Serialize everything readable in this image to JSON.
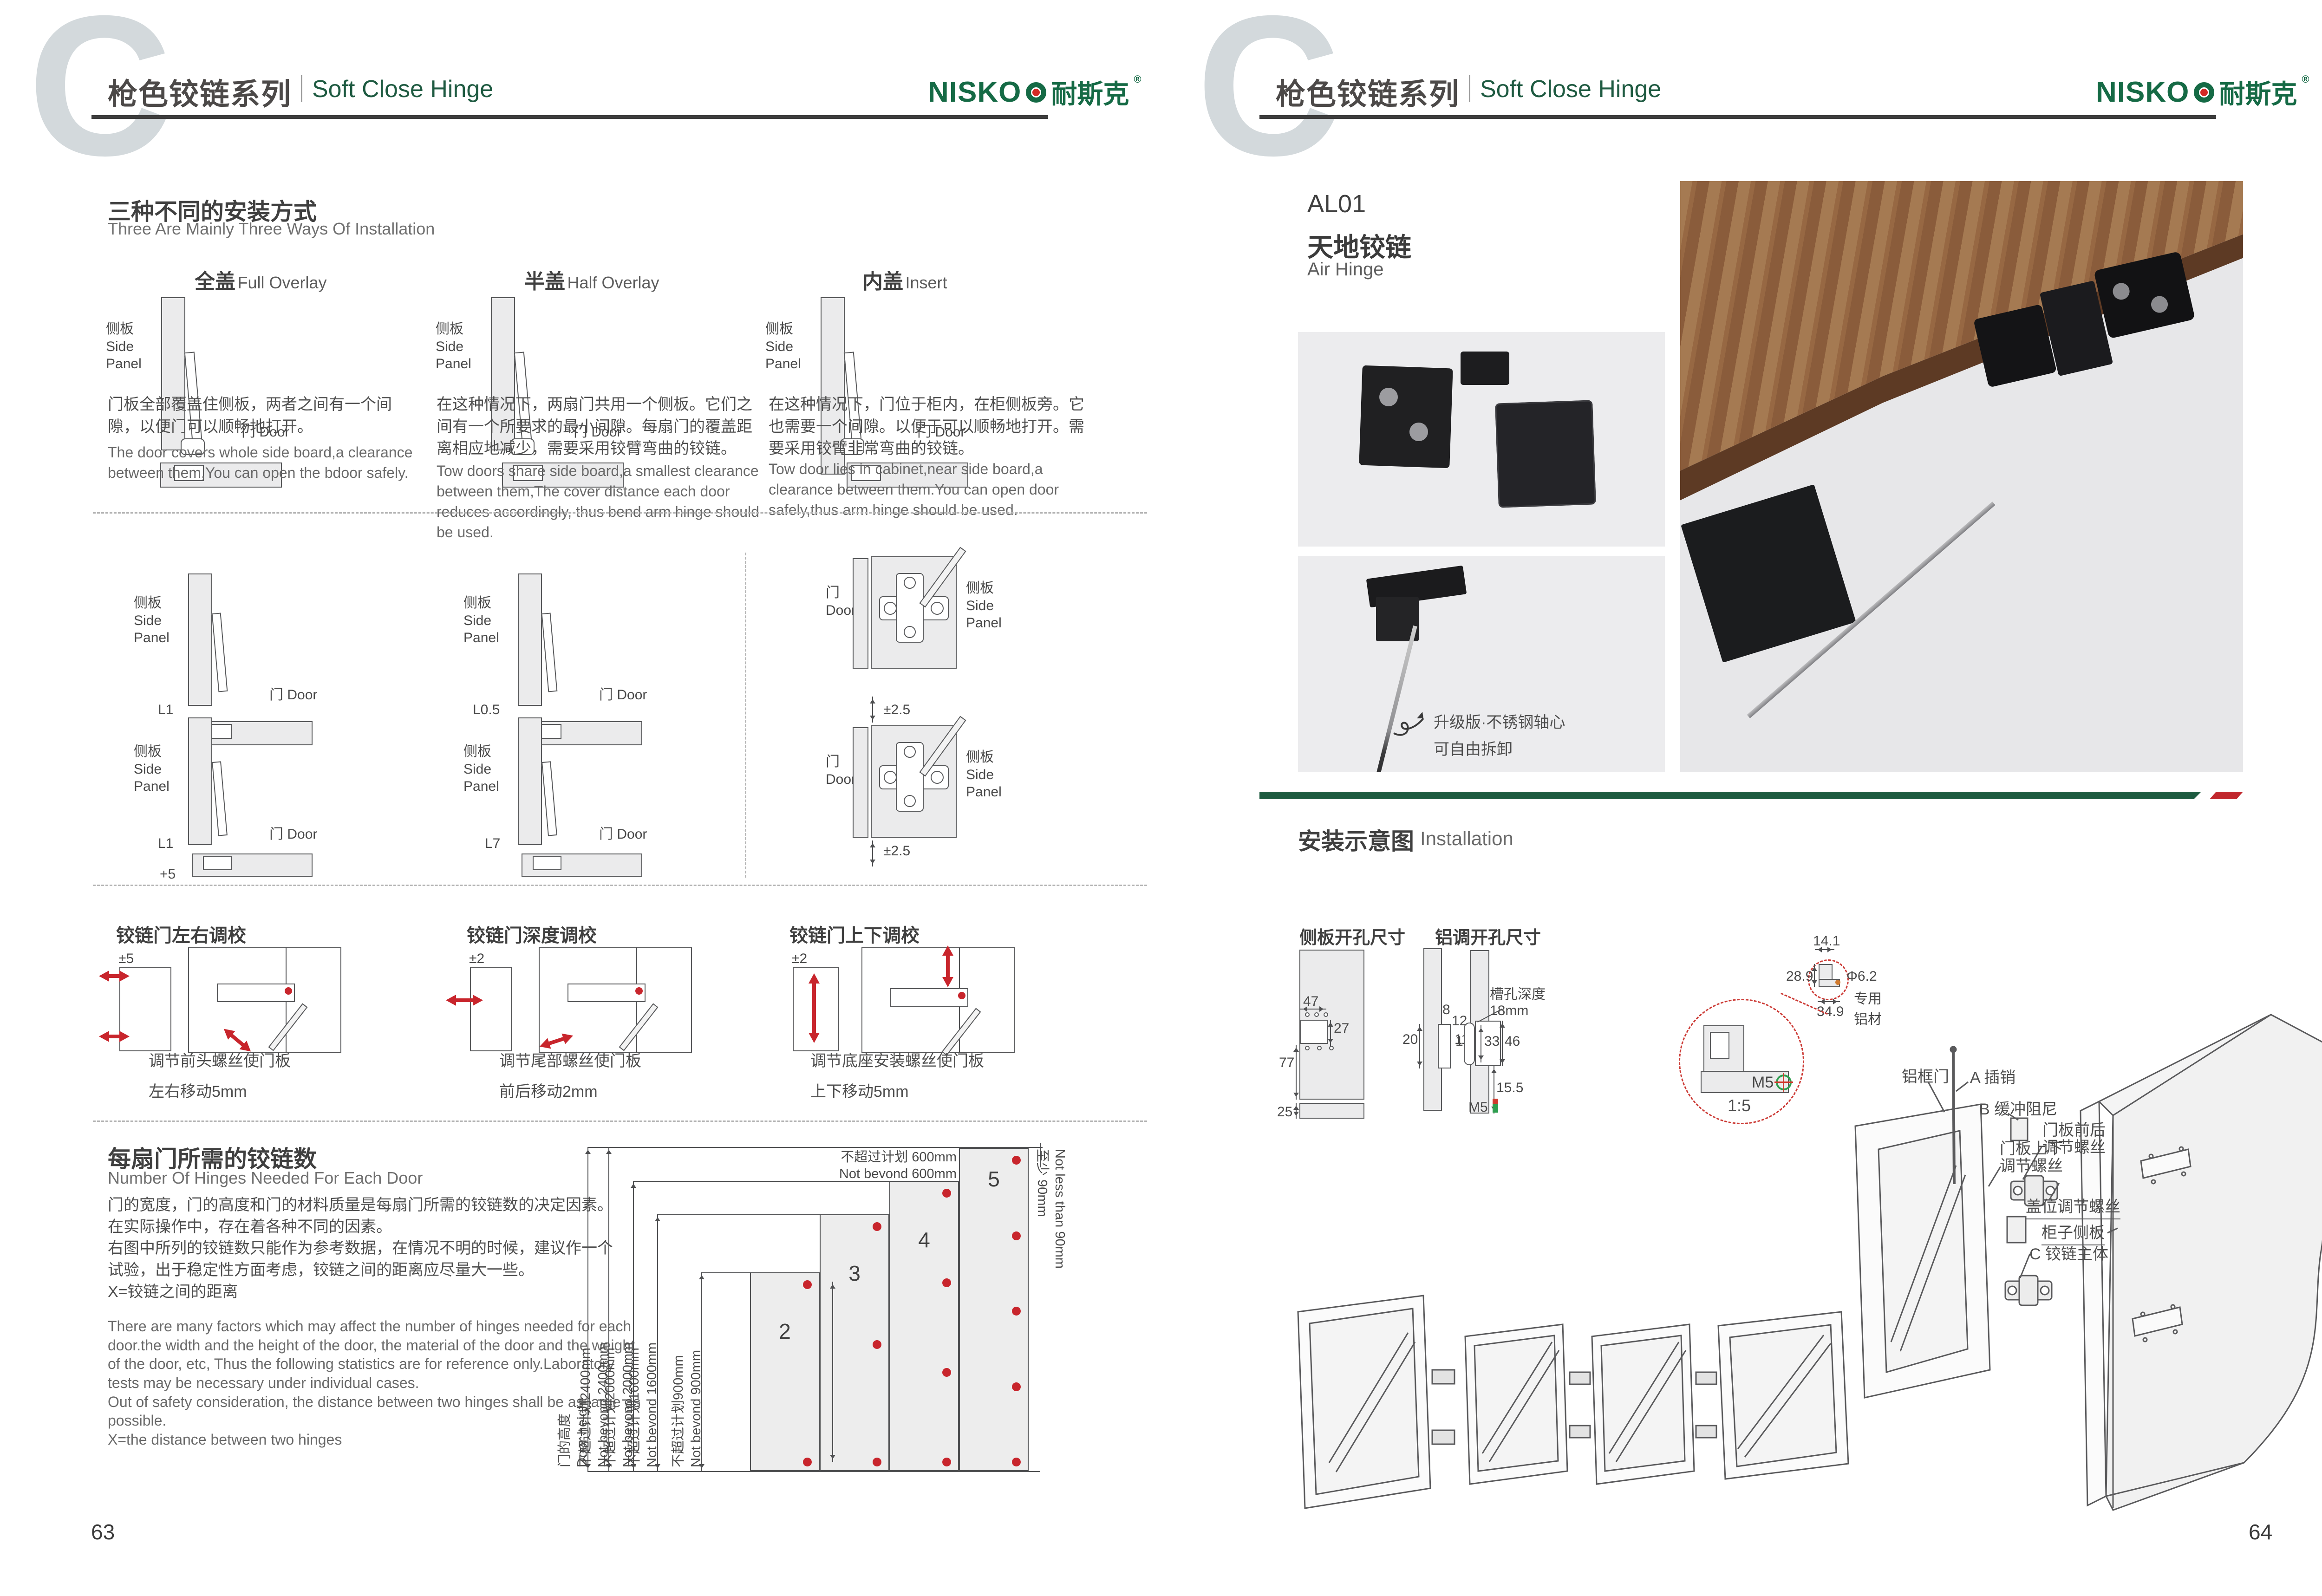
{
  "header": {
    "watermark": "C",
    "series_cn": "枪色铰链系列",
    "series_en": "Soft Close Hinge",
    "brand_latin": "NISKO",
    "brand_cn": "耐斯克",
    "brand_reg": "®"
  },
  "common": {
    "side_panel_cn": "侧板",
    "side_panel_en_1": "Side",
    "side_panel_en_2": "Panel",
    "door_cn": "门",
    "door_en": "Door"
  },
  "left_page": {
    "page_number": "63",
    "ways": {
      "title_cn": "三种不同的安装方式",
      "title_en": "Three Are Mainly Three Ways Of Installation",
      "columns": [
        {
          "type_cn": "全盖",
          "type_en": "Full Overlay",
          "desc_cn": "门板全部覆盖住侧板，两者之间有一个间隙，以便门可以顺畅地打开。",
          "desc_en": "The door covers whole side board,a clearance between them,You can open the bdoor safely."
        },
        {
          "type_cn": "半盖",
          "type_en": "Half Overlay",
          "desc_cn": "在这种情况下，两扇门共用一个侧板。它们之间有一个所要求的最小间隙。每扇门的覆盖距离相应地减少，需要采用铰臂弯曲的铰链。",
          "desc_en": "Tow doors share side board,a smallest clearance between them,The cover distance each door reduces accordingly, thus bend arm hinge should be used."
        },
        {
          "type_cn": "内盖",
          "type_en": "Insert",
          "desc_cn": "在这种情况下，门位于柜内，在柜侧板旁。它也需要一个间隙。以便于可以顺畅地打开。需要采用铰臂非常弯曲的铰链。",
          "desc_en": "Tow door lies in cabinet,near side board,a clearance between them.You can open door safely,thus arm hinge should be used."
        }
      ]
    },
    "overlay_dims": {
      "row1_left": "L1",
      "row1_right": "L0.5",
      "row2_left": "L1",
      "row2_left_extra": "+5",
      "row2_right": "L7",
      "plate_top": "±2.5",
      "plate_bottom": "±2.5"
    },
    "adjustments": [
      {
        "title": "铰链门左右调校",
        "range": "±5",
        "cap1": "调节前头螺丝使门板",
        "cap2": "左右移动5mm"
      },
      {
        "title": "铰链门深度调校",
        "range": "±2",
        "cap1": "调节尾部螺丝使门板",
        "cap2": "前后移动2mm"
      },
      {
        "title": "铰链门上下调校",
        "range": "±2",
        "cap1": "调节底座安装螺丝使门板",
        "cap2": "上下移动5mm"
      }
    ],
    "hinges_needed": {
      "title_cn": "每扇门所需的铰链数",
      "title_en": "Number Of Hinges Needed For Each Door",
      "cn_lines": [
        "门的宽度，门的高度和门的材料质量是每扇门所需的铰链数的决定因素。",
        "在实际操作中，存在着各种不同的因素。",
        "右图中所列的铰链数只能作为参考数据，在情况不明的时候，建议作一个",
        "试验，出于稳定性方面考虑，铰链之间的距离应尽量大一些。",
        "X=铰链之间的距离"
      ],
      "en_lines": [
        "There are many factors which may affect the number of hinges needed for each",
        "door.the width and the height of the door, the material of the door and the weight",
        "of the door, etc, Thus the following statistics are for reference only.Laboratory",
        "tests may be necessary under individual cases.",
        "Out of safety consideration, the distance between two hinges shall be as large as",
        "possible.",
        "X=the distance between two hinges"
      ]
    }
  },
  "chart_data": {
    "type": "bar",
    "title": "每扇门所需的铰链数 Number Of Hinges Needed For Each Door",
    "categories": [
      "不超过计划900mm",
      "不超过计划1600mm",
      "不超过计划2000mm",
      "不超过计划2400mm"
    ],
    "values": [
      2,
      3,
      4,
      5
    ],
    "ylabel": "门的高度 Door height",
    "bar_fill": "#ededed",
    "dot_color": "#c8252c",
    "dim_labels": [
      {
        "cn": "门的高度",
        "en": "Door height"
      },
      {
        "cn": "不超过计划2400mm",
        "en": "Not bevond 2400mm"
      },
      {
        "cn": "不超过计划2000mm",
        "en": "Not bevond 2000mm"
      },
      {
        "cn": "不超过计划1600mm",
        "en": "Not bevond 1600mm"
      },
      {
        "cn": "不超过计划900mm",
        "en": "Not bevond 900mm"
      }
    ],
    "width_note_cn": "不超过计划 600mm",
    "width_note_en": "Not bevond 600mm",
    "edge_note_cn": "至少 90mm",
    "edge_note_en": "Not less than 90mm"
  },
  "right_page": {
    "page_number": "64",
    "product": {
      "code": "AL01",
      "name_cn": "天地铰链",
      "name_en": "Air Hinge",
      "note_line1": "升级版·不锈钢轴心",
      "note_line2": "可自由拆卸"
    },
    "install": {
      "title_cn": "安装示意图",
      "title_en": "Installation",
      "drawing1_title": "侧板开孔尺寸",
      "drawing2_title": "铝调开孔尺寸",
      "dims": {
        "d47": "47",
        "d27": "27",
        "d77": "77",
        "d25": "25",
        "d8": "8",
        "d20": "20",
        "d11": "11",
        "d12": "12",
        "d1": "1",
        "d33": "33",
        "d46": "46",
        "d155": "15.5",
        "m5": "M5",
        "slot1": "槽孔深度",
        "slot2": "18mm"
      },
      "detail": {
        "d141": "14.1",
        "d289": "28.9",
        "d349": "34.9",
        "dia": "Φ6.2",
        "alu1": "专用",
        "alu2": "铝材",
        "m5": "M5",
        "scale": "1:5"
      },
      "exploded": {
        "alu_door": "铝框门",
        "a_pin": "A 插销",
        "b_damper": "B 缓冲阻尼",
        "fb1": "门板前后",
        "fb2": "调节螺丝",
        "ud1": "门板上下",
        "ud2": "调节螺丝",
        "cover": "盖位调节螺丝",
        "side": "柜子侧板",
        "c_body": "C 铰链主体"
      }
    }
  }
}
